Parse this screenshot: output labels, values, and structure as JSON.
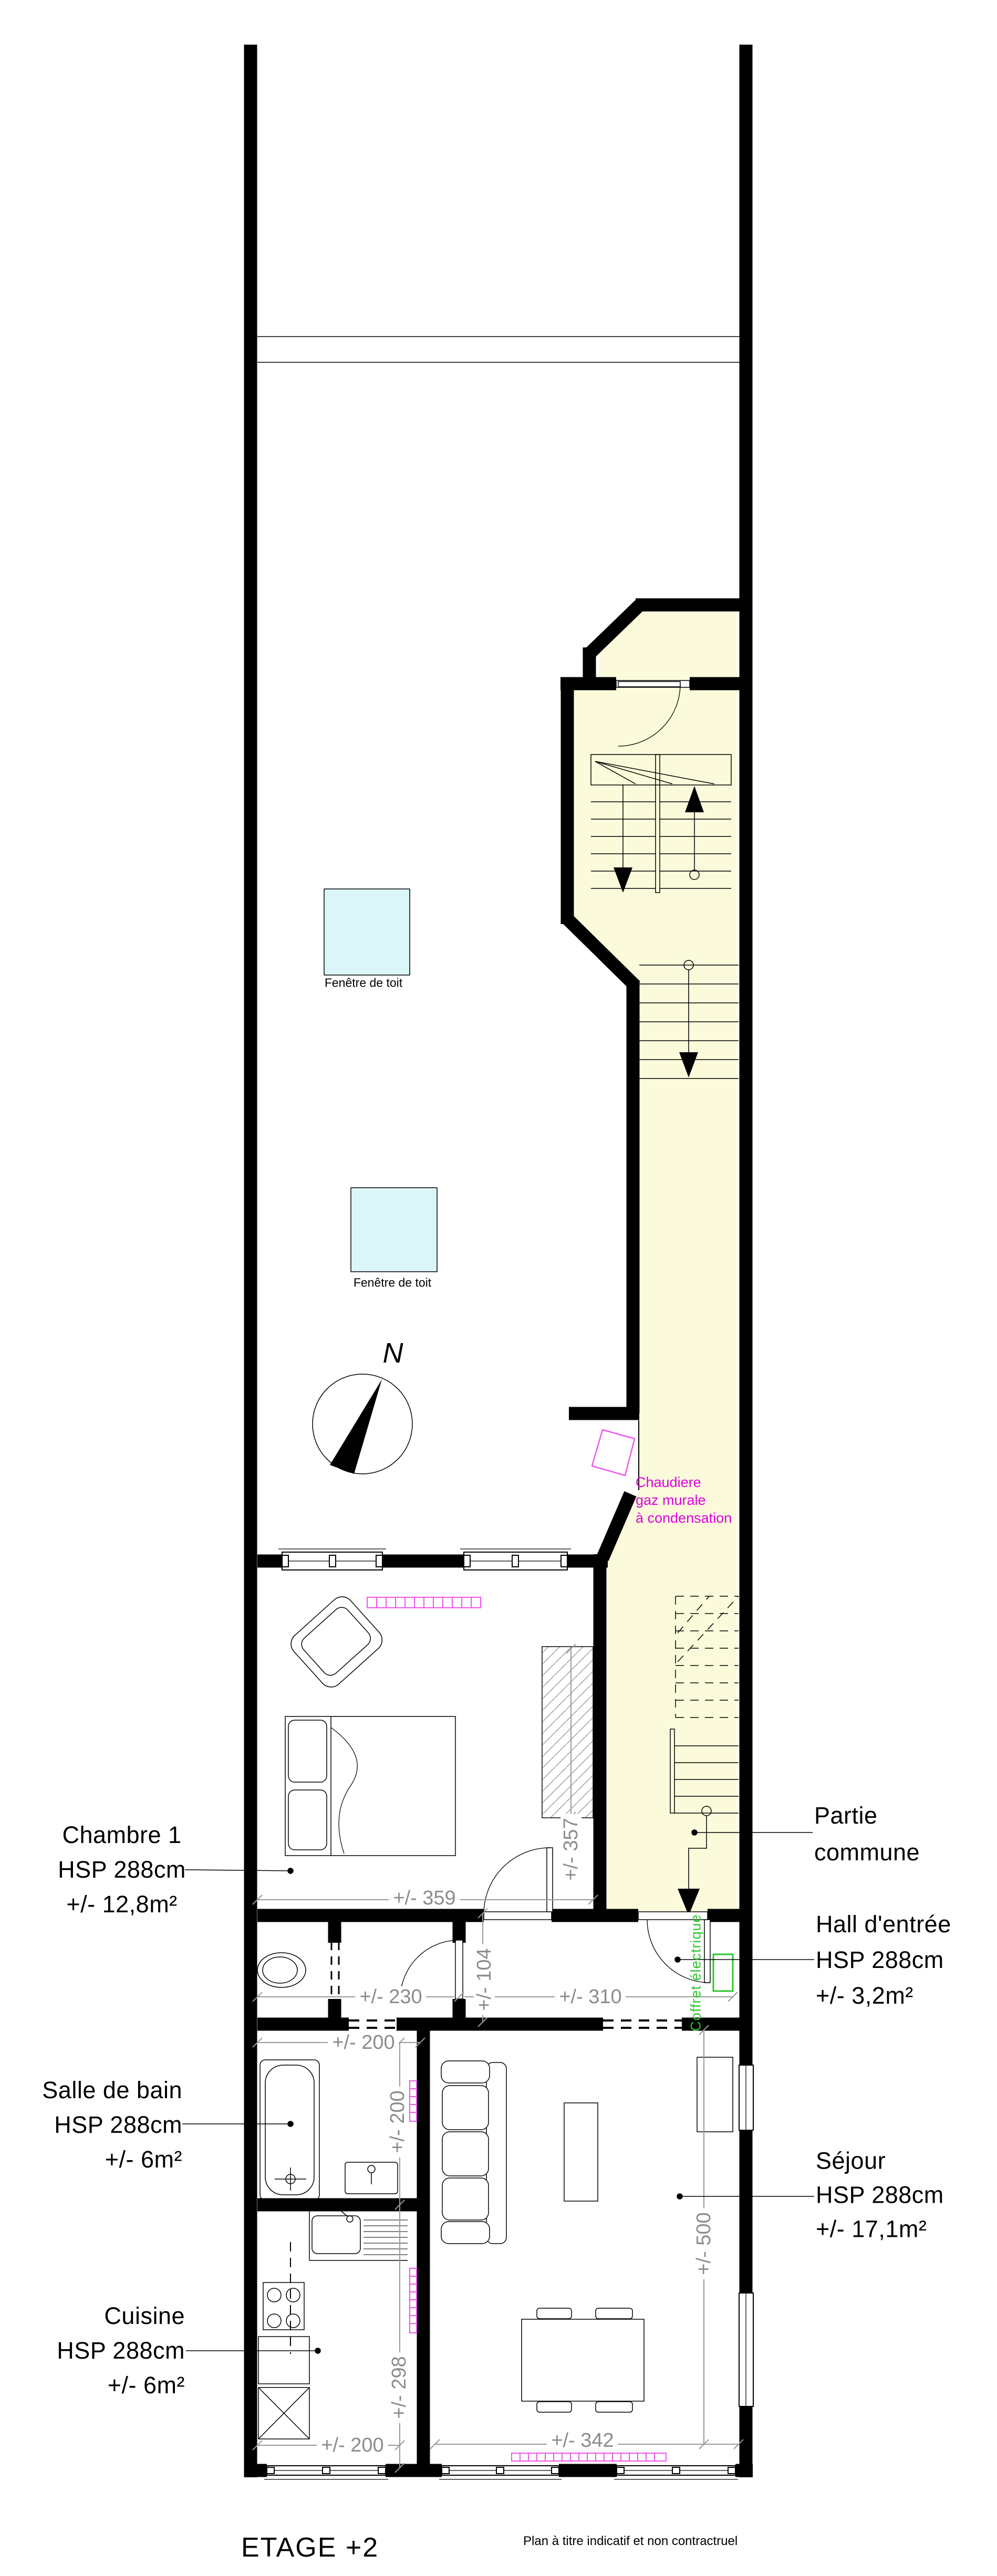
{
  "meta": {
    "title": "ETAGE +2",
    "disclaimer": "Plan à titre indicatif et non contractruel"
  },
  "colors": {
    "common_area_fill": "#FBFBDB",
    "skylight_fill": "#DBF6F8",
    "radiator_magenta": "#EE55EE",
    "note_magenta": "#DD00DD",
    "note_green": "#2DC62D",
    "dimension_gray": "#8C8C8C",
    "wall_black": "#000000"
  },
  "compass": {
    "label": "N"
  },
  "skylights": [
    {
      "label": "Fenêtre de toit"
    },
    {
      "label": "Fenêtre de toit"
    }
  ],
  "notes": {
    "boiler": [
      "Chaudiere",
      "gaz murale",
      "à condensation"
    ],
    "electrical": "Coffret électrique"
  },
  "rooms": {
    "chambre1": {
      "name": "Chambre 1",
      "ceiling": "HSP 288cm",
      "area": "+/- 12,8m²"
    },
    "salle_de_bain": {
      "name": "Salle de bain",
      "ceiling": "HSP 288cm",
      "area": "+/- 6m²"
    },
    "cuisine": {
      "name": "Cuisine",
      "ceiling": "HSP 288cm",
      "area": "+/- 6m²"
    },
    "partie_commune": {
      "name_line1": "Partie",
      "name_line2": "commune"
    },
    "hall_entree": {
      "name": "Hall d'entrée",
      "ceiling": "HSP 288cm",
      "area": "+/- 3,2m²"
    },
    "sejour": {
      "name": "Séjour",
      "ceiling": "HSP 288cm",
      "area": "+/- 17,1m²"
    }
  },
  "dimensions": {
    "chambre_width": "+/- 359",
    "placard_height": "+/- 357",
    "hall_depth": "+/- 104",
    "couloir_width": "+/- 230",
    "hall_width": "+/- 310",
    "sdb_width": "+/- 200",
    "sdb_depth": "+/- 200",
    "cuisine_depth": "+/- 298",
    "cuisine_width": "+/- 200",
    "sejour_width": "+/- 342",
    "sejour_depth": "+/- 500"
  }
}
